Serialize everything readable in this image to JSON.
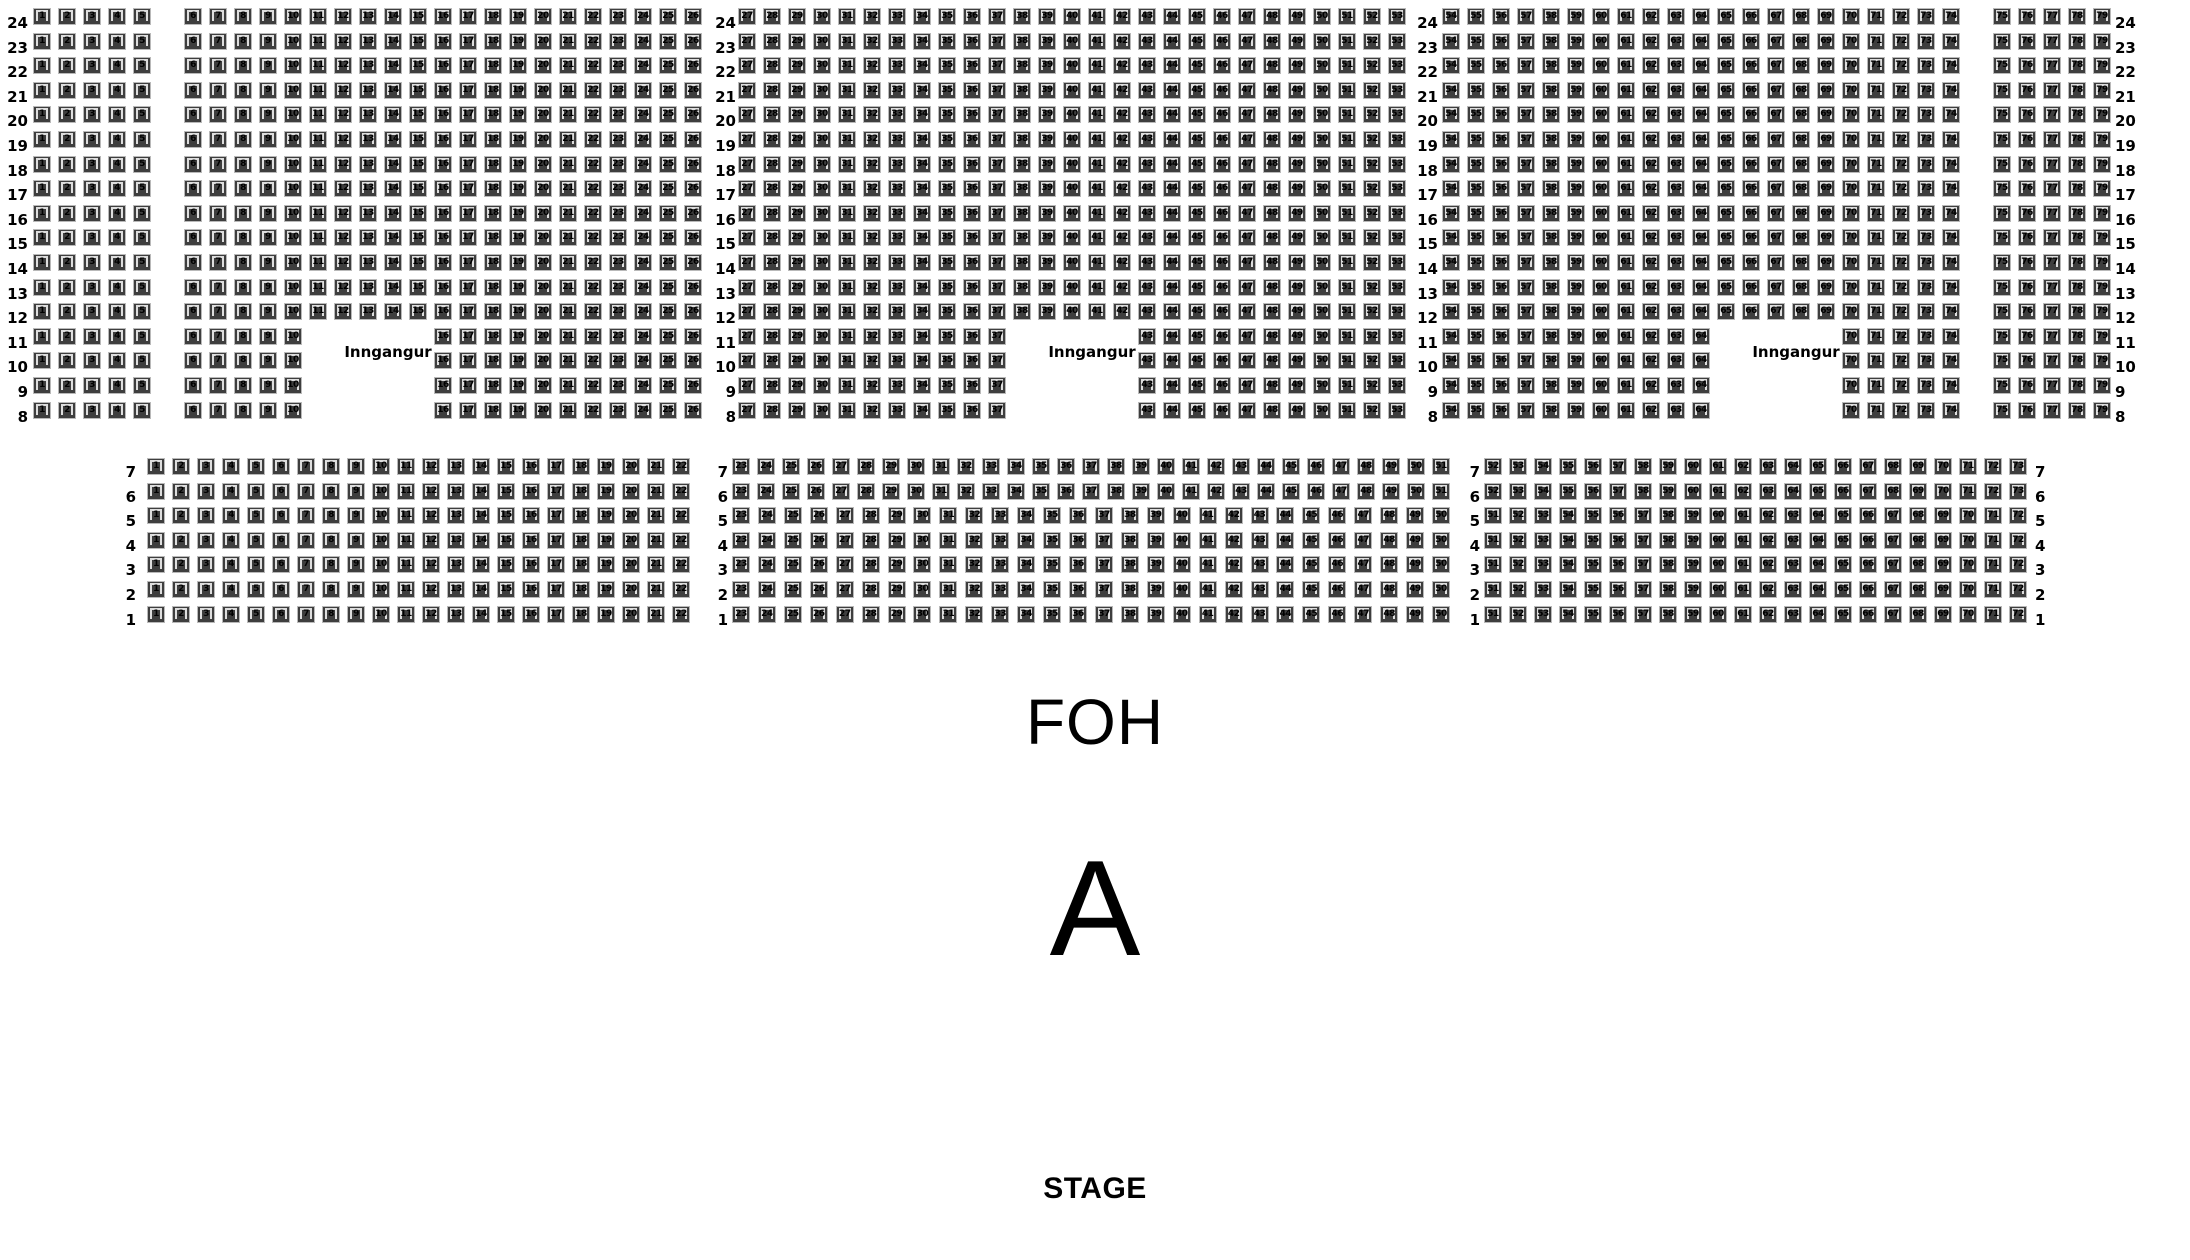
{
  "labels": {
    "entrance": "Inngangur",
    "foh": "FOH",
    "section": "A",
    "stage": "STAGE"
  },
  "colors": {
    "background": "#ffffff",
    "seat_fill": "#3e3e3e",
    "seat_back_highlight": "#dedede",
    "seat_frame": "#b9b9b9",
    "text": "#000000"
  },
  "top_section": {
    "row_numbers": [
      24,
      23,
      22,
      21,
      20,
      19,
      18,
      17,
      16,
      15,
      14,
      13,
      12,
      11,
      10,
      9,
      8
    ],
    "entrance_rows": [
      11,
      10,
      9,
      8
    ],
    "blocks": [
      {
        "id": "top-left",
        "seat_start": 1,
        "seat_end": 26,
        "aisle_after_seat": 5,
        "entrance_gap": {
          "from_seat": 11,
          "to_seat": 15
        }
      },
      {
        "id": "top-middle",
        "seat_start": 27,
        "seat_end": 53,
        "entrance_gap": {
          "from_seat": 38,
          "to_seat": 42
        }
      },
      {
        "id": "top-right",
        "seat_start": 54,
        "seat_end": 79,
        "aisle_after_seat": 74,
        "entrance_gap": {
          "from_seat": 65,
          "to_seat": 69
        }
      }
    ]
  },
  "bottom_section": {
    "row_numbers": [
      7,
      6,
      5,
      4,
      3,
      2,
      1
    ],
    "blocks": [
      {
        "id": "bottom-left",
        "row_ranges": [
          {
            "rows": [
              7,
              6,
              5,
              4,
              3,
              2,
              1
            ],
            "seat_start": 1,
            "seat_end": 22
          }
        ]
      },
      {
        "id": "bottom-middle",
        "row_ranges": [
          {
            "rows": [
              7,
              6
            ],
            "seat_start": 23,
            "seat_end": 51
          },
          {
            "rows": [
              5,
              4,
              3,
              2,
              1
            ],
            "seat_start": 23,
            "seat_end": 50
          }
        ]
      },
      {
        "id": "bottom-right",
        "row_ranges": [
          {
            "rows": [
              7,
              6
            ],
            "seat_start": 52,
            "seat_end": 73
          },
          {
            "rows": [
              5,
              4,
              3,
              2,
              1
            ],
            "seat_start": 51,
            "seat_end": 72
          }
        ]
      }
    ]
  }
}
